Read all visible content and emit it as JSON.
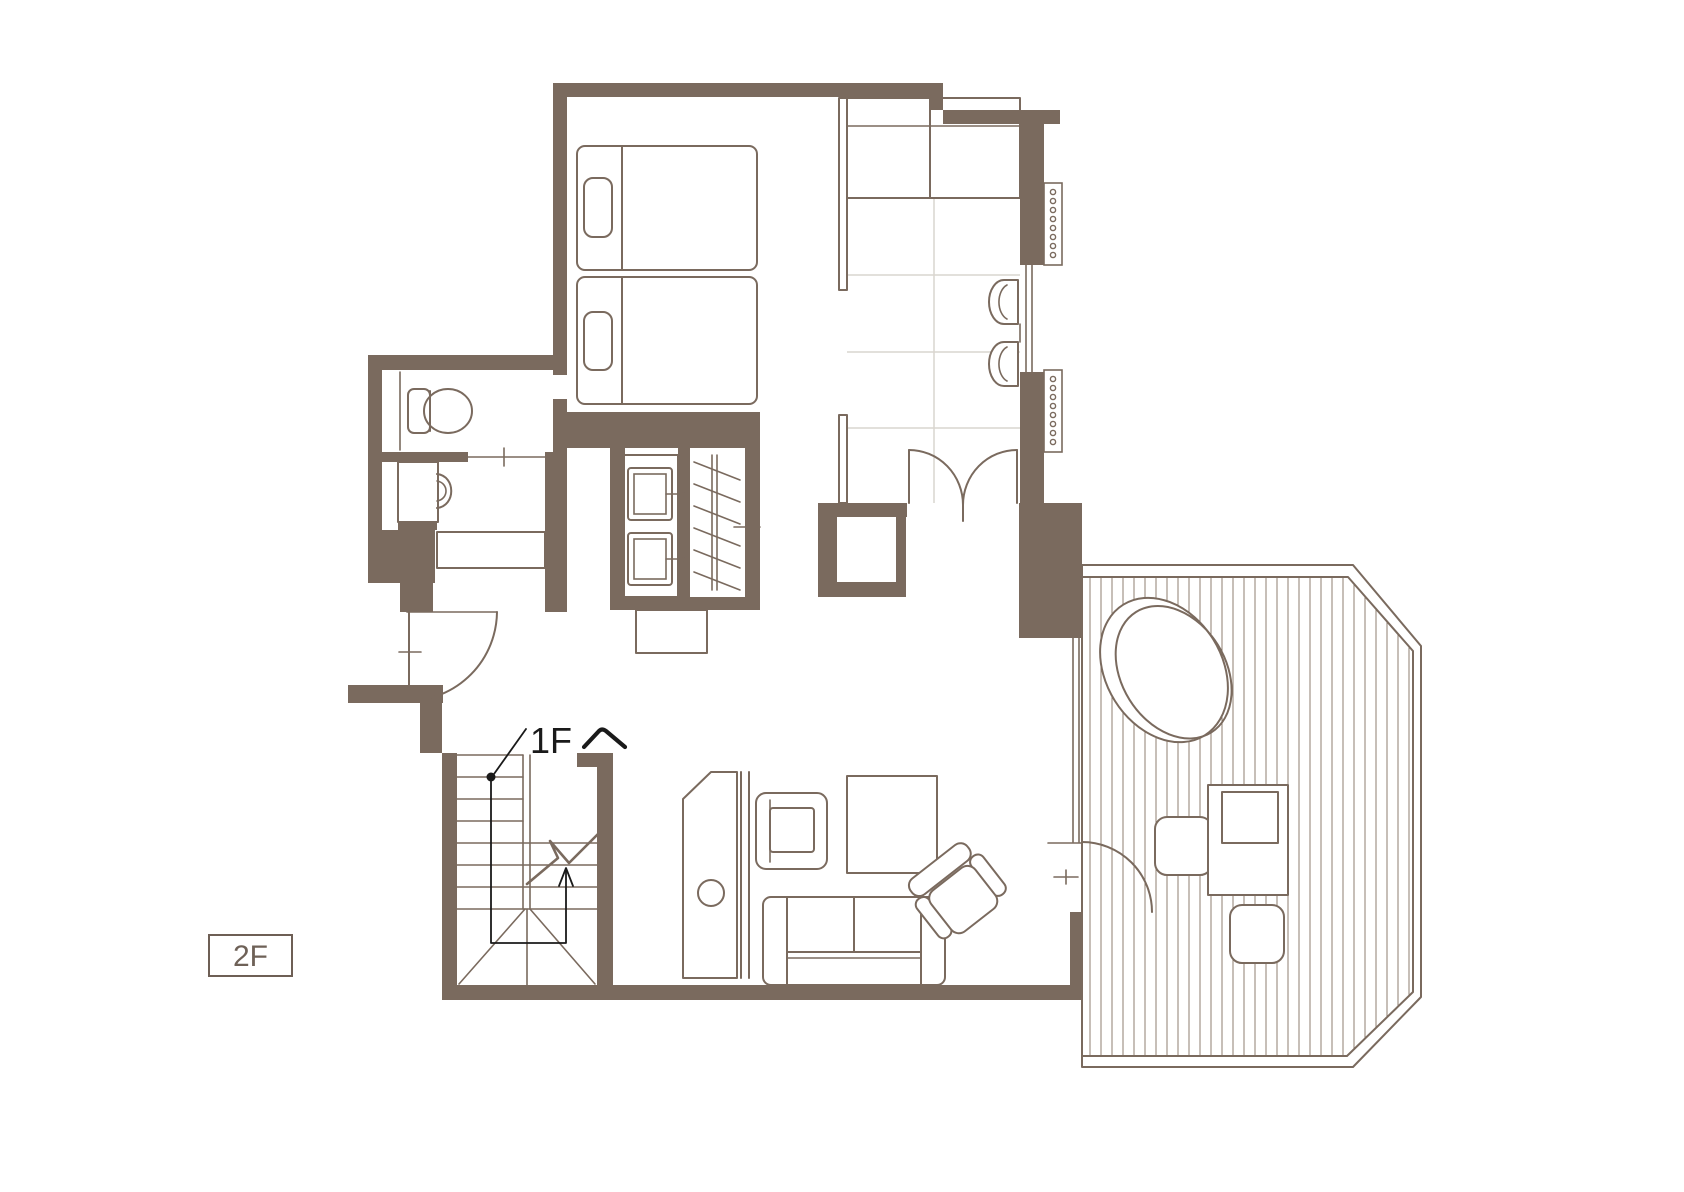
{
  "title": "Second floor plan (guest suite with twin bedroom, Japanese-style room, living room and open-air bath deck)",
  "labels": {
    "floor_badge": "2F",
    "stair_note_full": "1Fへ",
    "stair_note_text": "1F"
  },
  "colors": {
    "wall": "#7A6A5E",
    "line": "#7A6A5E",
    "tatami_grid": "#D9D5CF",
    "deck_slat": "#8F7F71",
    "ink": "#1A1A1A",
    "label_text": "#6E6157",
    "label_box_border": "#6E5F55",
    "background": "#FFFFFF"
  },
  "rooms": [
    {
      "id": "twin-bedroom",
      "contents": [
        "twin-bed-1",
        "twin-bed-2"
      ]
    },
    {
      "id": "japanese-style-room",
      "contents": [
        "oshiire-closet",
        "tatami-mats",
        "window-chairs",
        "double-doors"
      ]
    },
    {
      "id": "toilet-room",
      "contents": [
        "toilet",
        "sliding-door"
      ]
    },
    {
      "id": "washroom",
      "contents": [
        "washbasin",
        "vanity-double-sink",
        "hanger-closet"
      ]
    },
    {
      "id": "living-room",
      "contents": [
        "tv-board",
        "armchair",
        "square-table",
        "sofa",
        "lounge-chair"
      ]
    },
    {
      "id": "staircase",
      "contents": [
        "treads",
        "winders",
        "route-arrow-to-1F"
      ]
    },
    {
      "id": "wood-deck",
      "contents": [
        "open-air-bath-tub",
        "deck-stool-1",
        "deck-table",
        "deck-stool-2",
        "deck-door"
      ]
    }
  ],
  "symbols": [
    {
      "id": "shutter-coil-marks",
      "meaning": "window shutter/curtain symbol on right wall"
    },
    {
      "id": "stair-break-line",
      "meaning": "flight cut symbol"
    },
    {
      "id": "route-dot-and-arrow",
      "meaning": "path from this floor down to 1F"
    }
  ]
}
